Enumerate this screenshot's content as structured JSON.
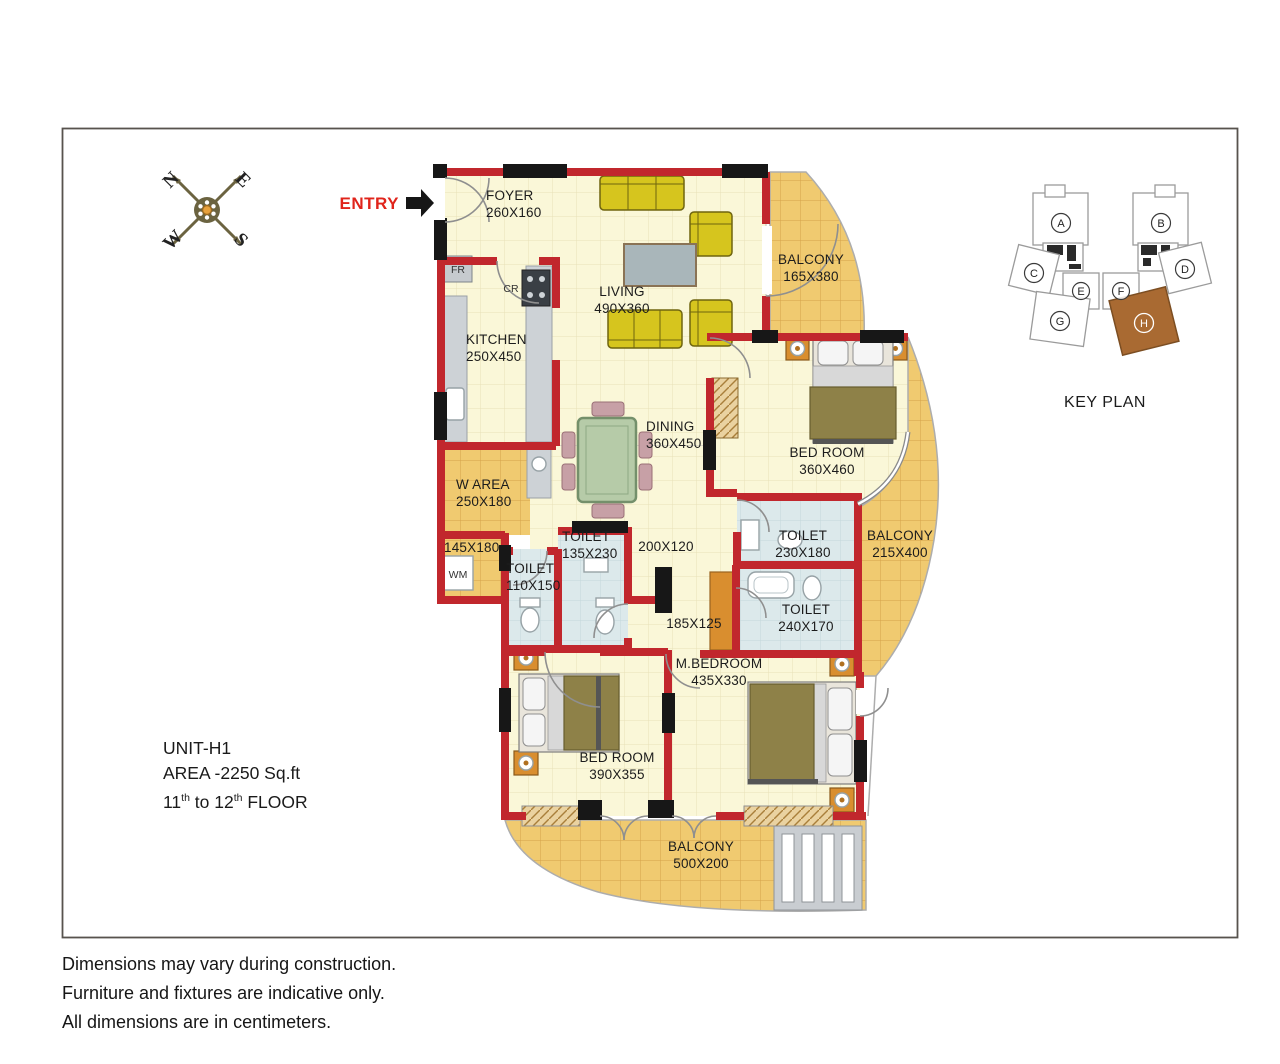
{
  "compass": {
    "north": "N",
    "east": "E",
    "west": "W",
    "south": "S"
  },
  "entry": {
    "label": "ENTRY"
  },
  "rooms": {
    "foyer": {
      "name": "FOYER",
      "dims": "260X160"
    },
    "living": {
      "name": "LIVING",
      "dims": "490X360"
    },
    "kitchen": {
      "name": "KITCHEN",
      "dims": "250X450"
    },
    "balcony_top": {
      "name": "BALCONY",
      "dims": "165X380"
    },
    "bedroom_right": {
      "name": "BED ROOM",
      "dims": "360X460"
    },
    "dining": {
      "name": "DINING",
      "dims": "360X450"
    },
    "w_area": {
      "name": "W AREA",
      "dims": "250X180"
    },
    "utility": {
      "dims": "145X180"
    },
    "toilet_small": {
      "name": "TOILET",
      "dims": "110X150"
    },
    "toilet_mid": {
      "name": "TOILET",
      "dims": "135X230"
    },
    "passage": {
      "dims": "200X120"
    },
    "toilet_right": {
      "name": "TOILET",
      "dims": "230X180"
    },
    "balcony_right": {
      "name": "BALCONY",
      "dims": "215X400"
    },
    "toilet_master": {
      "name": "TOILET",
      "dims": "240X170"
    },
    "passage_master": {
      "dims": "185X125"
    },
    "master_bedroom": {
      "name": "M.BEDROOM",
      "dims": "435X330"
    },
    "bedroom_bottom": {
      "name": "BED ROOM",
      "dims": "390X355"
    },
    "balcony_bottom": {
      "name": "BALCONY",
      "dims": "500X200"
    }
  },
  "appliances": {
    "fridge": "FR",
    "cooking_range": "CR",
    "washing_machine": "WM"
  },
  "key_plan": {
    "title": "KEY PLAN",
    "blocks": [
      "A",
      "B",
      "C",
      "D",
      "E",
      "F",
      "G",
      "H"
    ],
    "highlighted_block": "H",
    "highlight_color": "#A96A32"
  },
  "unit": {
    "name": "UNIT-H1",
    "area": "AREA -2250 Sq.ft",
    "floor": {
      "p1": "11",
      "sup1": "th",
      "p2": " to 12",
      "sup2": "th",
      "p3": " FLOOR"
    }
  },
  "footer": {
    "lines": [
      "Dimensions may vary during construction.",
      "Furniture and fixtures are indicative only.",
      "All dimensions are in centimeters."
    ]
  },
  "colors": {
    "wall_red": "#C1272D",
    "floor_cream": "#FAF7D8",
    "balcony_tan": "#F0CA70",
    "toilet_blue": "#DCE9EB",
    "entry_red": "#E0241B",
    "keyplan_brown": "#A96A32"
  }
}
